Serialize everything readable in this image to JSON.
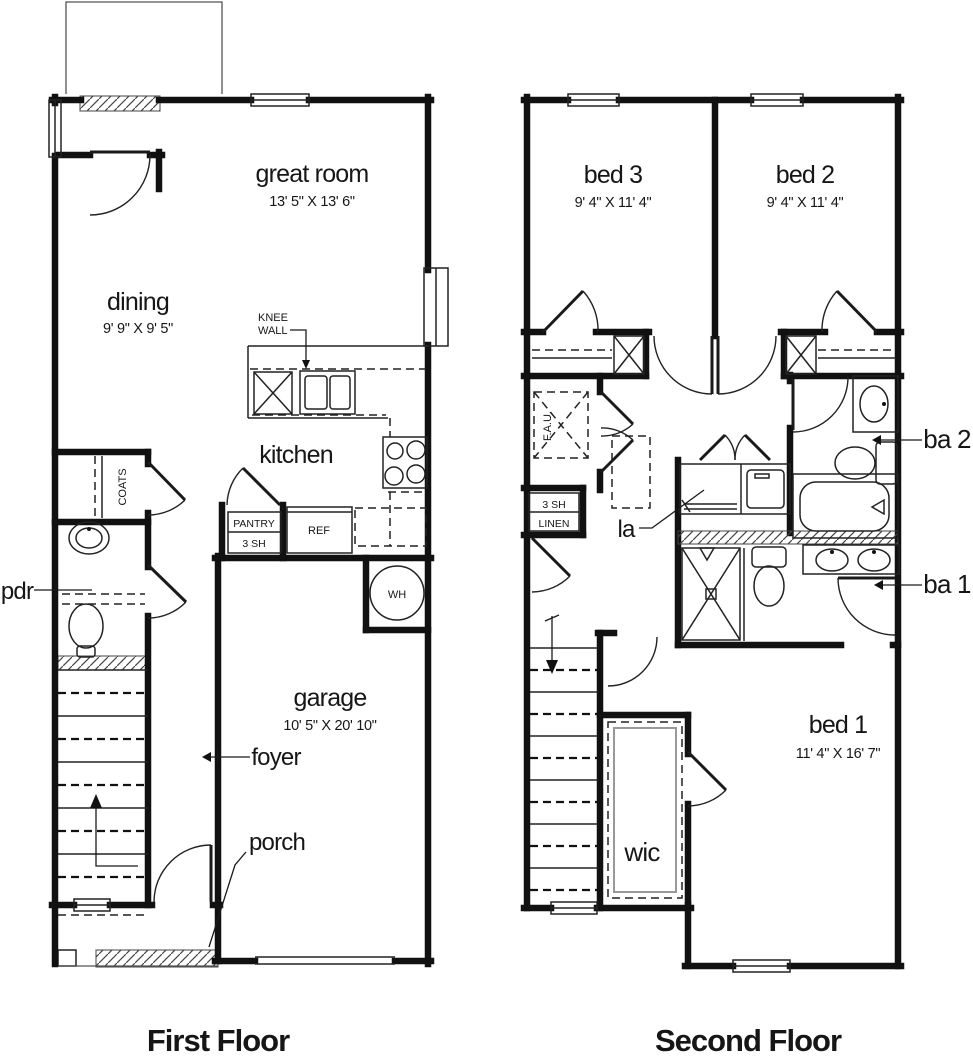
{
  "titles": {
    "first_floor": "First Floor",
    "second_floor": "Second Floor"
  },
  "first_floor": {
    "great_room": {
      "name": "great room",
      "dims": "13' 5\" X 13' 6\""
    },
    "dining": {
      "name": "dining",
      "dims": "9' 9\" X 9' 5\""
    },
    "kitchen": {
      "name": "kitchen"
    },
    "knee_wall": {
      "line1": "KNEE",
      "line2": "WALL"
    },
    "coats_closet": {
      "name": "COATS"
    },
    "pantry": {
      "line1": "PANTRY",
      "line2": "3 SH"
    },
    "refrigerator": {
      "name": "REF"
    },
    "water_heater": {
      "name": "WH"
    },
    "powder_room": {
      "name": "pdr"
    },
    "garage": {
      "name": "garage",
      "dims": "10' 5\" X 20' 10\""
    },
    "foyer": {
      "name": "foyer"
    },
    "porch": {
      "name": "porch"
    }
  },
  "second_floor": {
    "bed_3": {
      "name": "bed 3",
      "dims": "9' 4\" X 11' 4\""
    },
    "bed_2": {
      "name": "bed 2",
      "dims": "9' 4\" X 11' 4\""
    },
    "bed_1": {
      "name": "bed 1",
      "dims": "11' 4\" X 16' 7\""
    },
    "fau": {
      "name": "F.A.U."
    },
    "linen": {
      "line1": "3 SH",
      "line2": "LINEN"
    },
    "laundry": {
      "name": "la"
    },
    "bath_2": {
      "name": "ba 2"
    },
    "bath_1": {
      "name": "ba 1"
    },
    "wic": {
      "name": "wic"
    }
  },
  "colors": {
    "line": "#111111",
    "background": "#ffffff"
  }
}
